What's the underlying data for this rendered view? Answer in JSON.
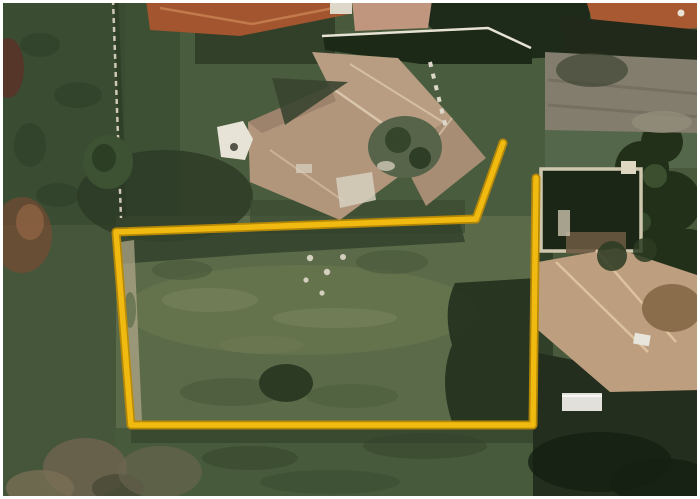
{
  "meta": {
    "image_type": "satellite-aerial-photo",
    "width_px": 700,
    "height_px": 499,
    "frame_color": "#ffffff"
  },
  "boundary": {
    "points": "503,143 476,219 116,232 131,425 533,425 536,178",
    "color_main": "#f0ba10",
    "color_edge": "#b98a06",
    "shape": "open-polyline",
    "vertex_count": 6
  },
  "palette": {
    "lawn_base": "#49593c",
    "lawn_dark": "#3a4c31",
    "plot_interior": "#5b6b49",
    "plot_light_band": "#74805a",
    "tree_dark": "#1f2b1a",
    "shadow_olive": "#2e3b26",
    "main_roof_tan": "#b1967c",
    "roof_ridge_light": "#d9c5ab",
    "neighbor_roof_orange": "#a2552f",
    "driveway_gray": "#837d6d",
    "bottom_roof_tan": "#bd9e7f",
    "white_structure": "#e7e3d6",
    "dirt_path": "#b3a98d",
    "dry_brush_brown": "#7a4a33"
  },
  "scene": {
    "overlay": "property-boundary-outline",
    "features": [
      "main-house-tan-hip-roof-center",
      "white-gazebo-left-of-house",
      "inner-courtyard-trees",
      "neighbor-orange-roof-top-left",
      "neighbor-orange-roof-top-right",
      "white-boundary-wall-top",
      "left-fence-line-with-posts",
      "gray-driveway-right",
      "pool-courtyard-enclosure-right",
      "neighbor-tan-roof-bottom-right",
      "white-van-bottom-right",
      "open-lawn-parcel-inside-boundary",
      "dirt-path-along-left-fence",
      "rock-cluster-in-lawn",
      "tree-shadow-masses",
      "dry-brush-bottom-left"
    ]
  }
}
